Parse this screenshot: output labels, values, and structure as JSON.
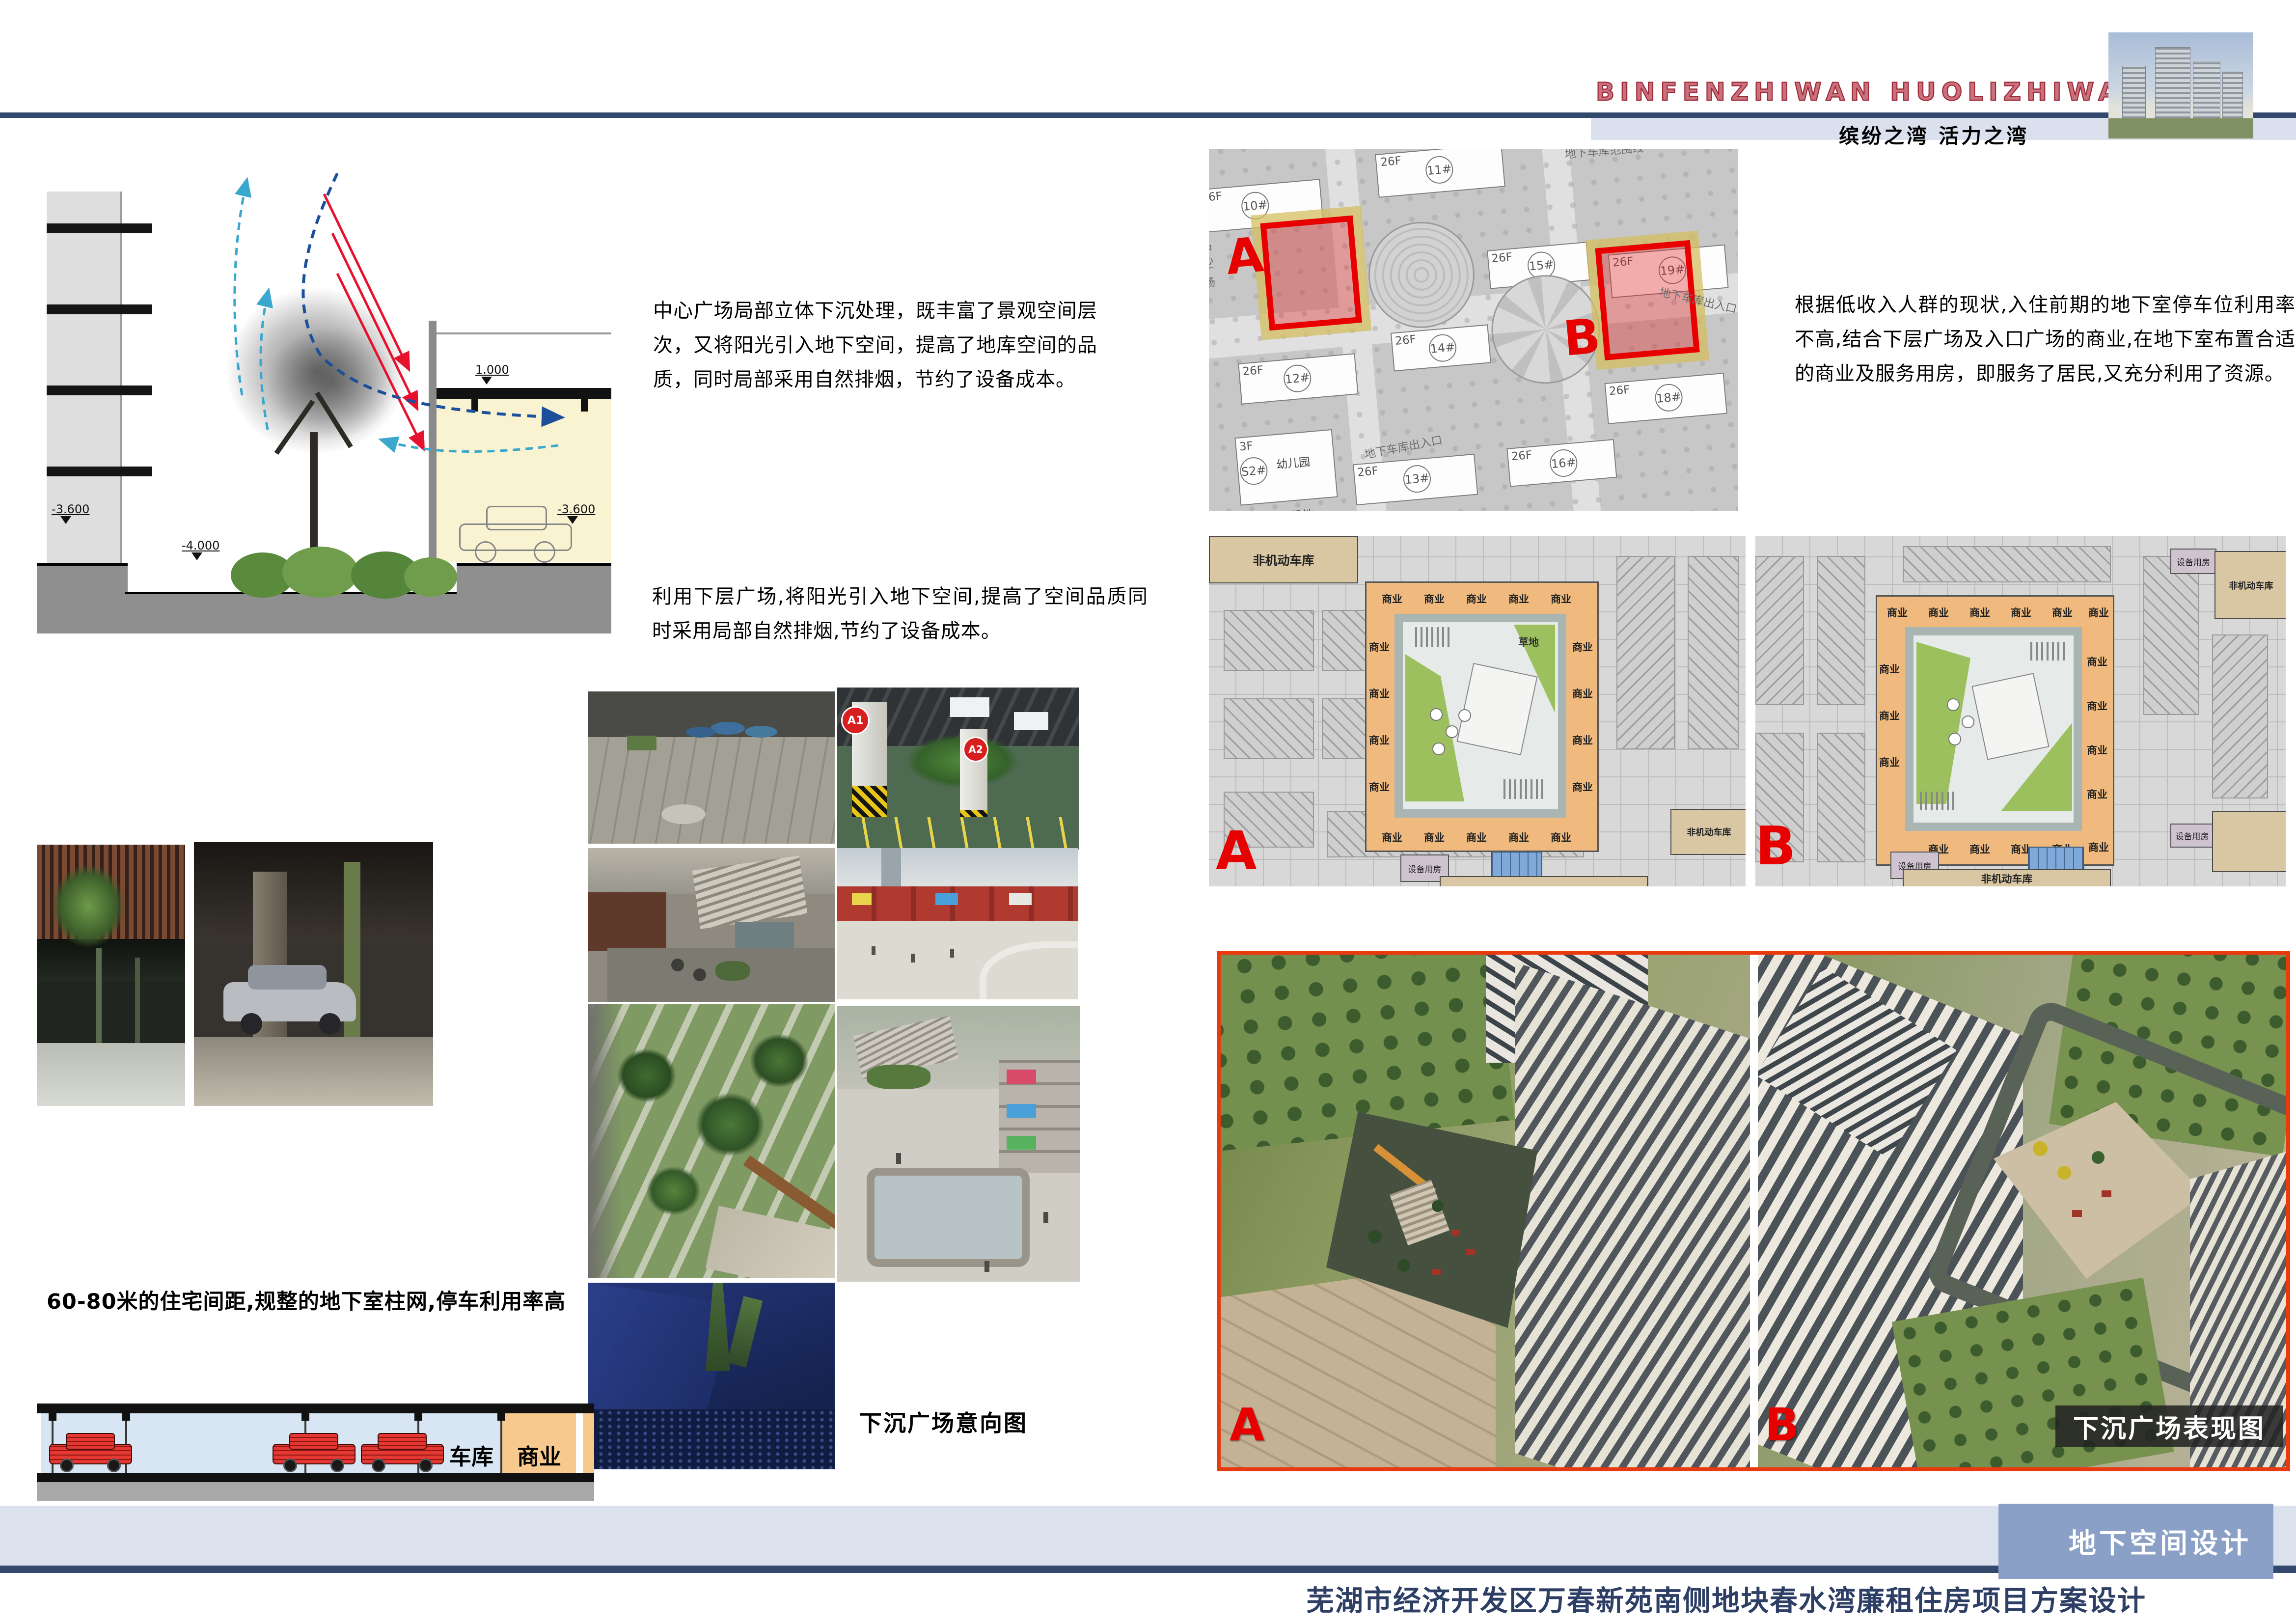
{
  "header": {
    "title_en": "BINFENZHIWAN HUOLIZHIWAN",
    "subtitle": "缤纷之湾 活力之湾"
  },
  "texts": {
    "block1": "中心广场局部立体下沉处理，既丰富了景观空间层次，又将阳光引入地下空间，提高了地库空间的品质，同时局部采用自然排烟，节约了设备成本。",
    "block2": "利用下层广场,将阳光引入地下空间,提高了空间品质同时采用局部自然排烟,节约了设备成本。",
    "block3": "根据低收入人群的现状,入住前期的地下室停车位利用率不高,结合下层广场及入口广场的商业,在地下室布置合适的商业及服务用房，即服务了居民,又充分利用了资源。",
    "block4": "60-80米的住宅间距,规整的地下室柱网,停车利用率高"
  },
  "section_diagram": {
    "levels": {
      "upper": "1.000",
      "left": "-3.600",
      "pit": "-4.000",
      "right": "-3.600"
    }
  },
  "site_plan": {
    "marker_a": "A",
    "marker_b": "B",
    "floors": "26F",
    "buildings": [
      "10#",
      "11#",
      "12#",
      "13#",
      "14#",
      "15#",
      "16#",
      "18#",
      "19#"
    ],
    "labels": {
      "boundary": "地下车库范围线",
      "exit": "地下车库出入口",
      "center_plaza": "中心广场",
      "kindergarten": "幼儿园",
      "playground": "活动场地",
      "kinder_entry": "幼儿园入口",
      "kinder_floors": "3F",
      "kinder_no": "S2#"
    }
  },
  "floor_plans": {
    "shop": "商业",
    "bike_garage": "非机动车库",
    "equipment": "设备用房",
    "grass": "草地",
    "marker_a": "A",
    "marker_b": "B"
  },
  "photos": {
    "badge_a1": "A1",
    "badge_a2": "A2"
  },
  "garage_section": {
    "garage": "车库",
    "shop": "商业"
  },
  "captions": {
    "intent": "下沉广场意向图",
    "render": "下沉广场表现图"
  },
  "renderings": {
    "marker_a": "A",
    "marker_b": "B"
  },
  "footer": {
    "tab": "地下空间设计",
    "title": "芜湖市经济开发区万春新苑南侧地块春水湾廉租住房项目方案设计"
  }
}
